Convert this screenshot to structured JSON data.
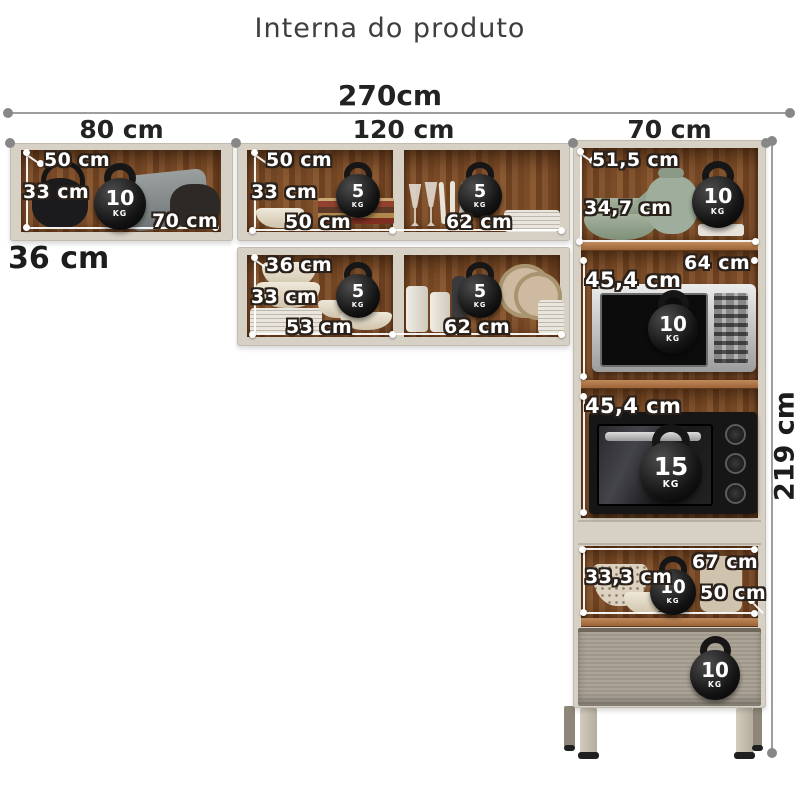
{
  "title": "Interna do produto",
  "overall": {
    "width_label": "270cm",
    "height_label": "219 cm",
    "sections": [
      {
        "label": "80 cm"
      },
      {
        "label": "120 cm"
      },
      {
        "label": "70 cm"
      }
    ]
  },
  "left_cabinet": {
    "depth": "50 cm",
    "height": "33 cm",
    "width": "70 cm",
    "base_depth": "36 cm",
    "max_weight": {
      "value": "10",
      "unit": "KG"
    }
  },
  "middle_top_cabinet": {
    "depth": "50 cm",
    "height": "33 cm",
    "left_width": "50 cm",
    "right_width": "62 cm",
    "left_max_weight": {
      "value": "5",
      "unit": "KG"
    },
    "right_max_weight": {
      "value": "5",
      "unit": "KG"
    }
  },
  "middle_bottom_cabinet": {
    "depth": "36 cm",
    "height": "33 cm",
    "left_width": "53 cm",
    "right_width": "62 cm",
    "left_max_weight": {
      "value": "5",
      "unit": "KG"
    },
    "right_max_weight": {
      "value": "5",
      "unit": "KG"
    }
  },
  "tower": {
    "top_shelf": {
      "depth": "51,5 cm",
      "height": "34,7 cm",
      "max_weight": {
        "value": "10",
        "unit": "KG"
      }
    },
    "microwave_shelf": {
      "width": "64 cm",
      "height": "45,4 cm",
      "max_weight": {
        "value": "10",
        "unit": "KG"
      }
    },
    "oven_shelf": {
      "height": "45,4 cm",
      "max_weight": {
        "value": "15",
        "unit": "KG"
      }
    },
    "open_shelf": {
      "width": "67 cm",
      "height": "33,3 cm",
      "depth": "50 cm",
      "max_weight": {
        "value": "10",
        "unit": "KG"
      }
    },
    "drawer": {
      "max_weight": {
        "value": "10",
        "unit": "KG"
      }
    }
  },
  "colors": {
    "frame": "#d6d0c5",
    "wood": "#7c4c28",
    "drawer_front": "#a79f91",
    "dimension_line": "#9e9e9e",
    "label_text": "#ffffff",
    "label_outline": "#2a211a"
  }
}
